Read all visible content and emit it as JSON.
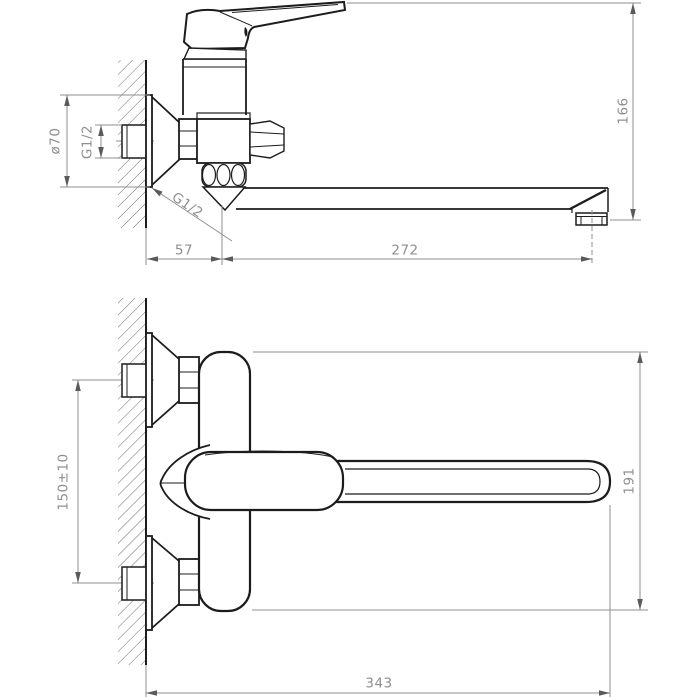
{
  "drawing": {
    "kind": "technical dimension drawing, two orthographic views of a wall-mounted single-lever mixer faucet",
    "colors": {
      "outline": "#1c1c1c",
      "dimension": "#8f8f8f",
      "arrow": "#5a5a5a"
    },
    "labels": {
      "top_view": {
        "flange_diameter": "ø70",
        "wall_connection_thread": "G1/2",
        "spout_connection_thread": "G1/2",
        "wall_to_spout_axis": "57",
        "spout_axis_to_outlet": "272",
        "overall_height": "166"
      },
      "front_view": {
        "connection_centers": "150±10",
        "body_height": "191",
        "overall_length": "343"
      }
    }
  }
}
